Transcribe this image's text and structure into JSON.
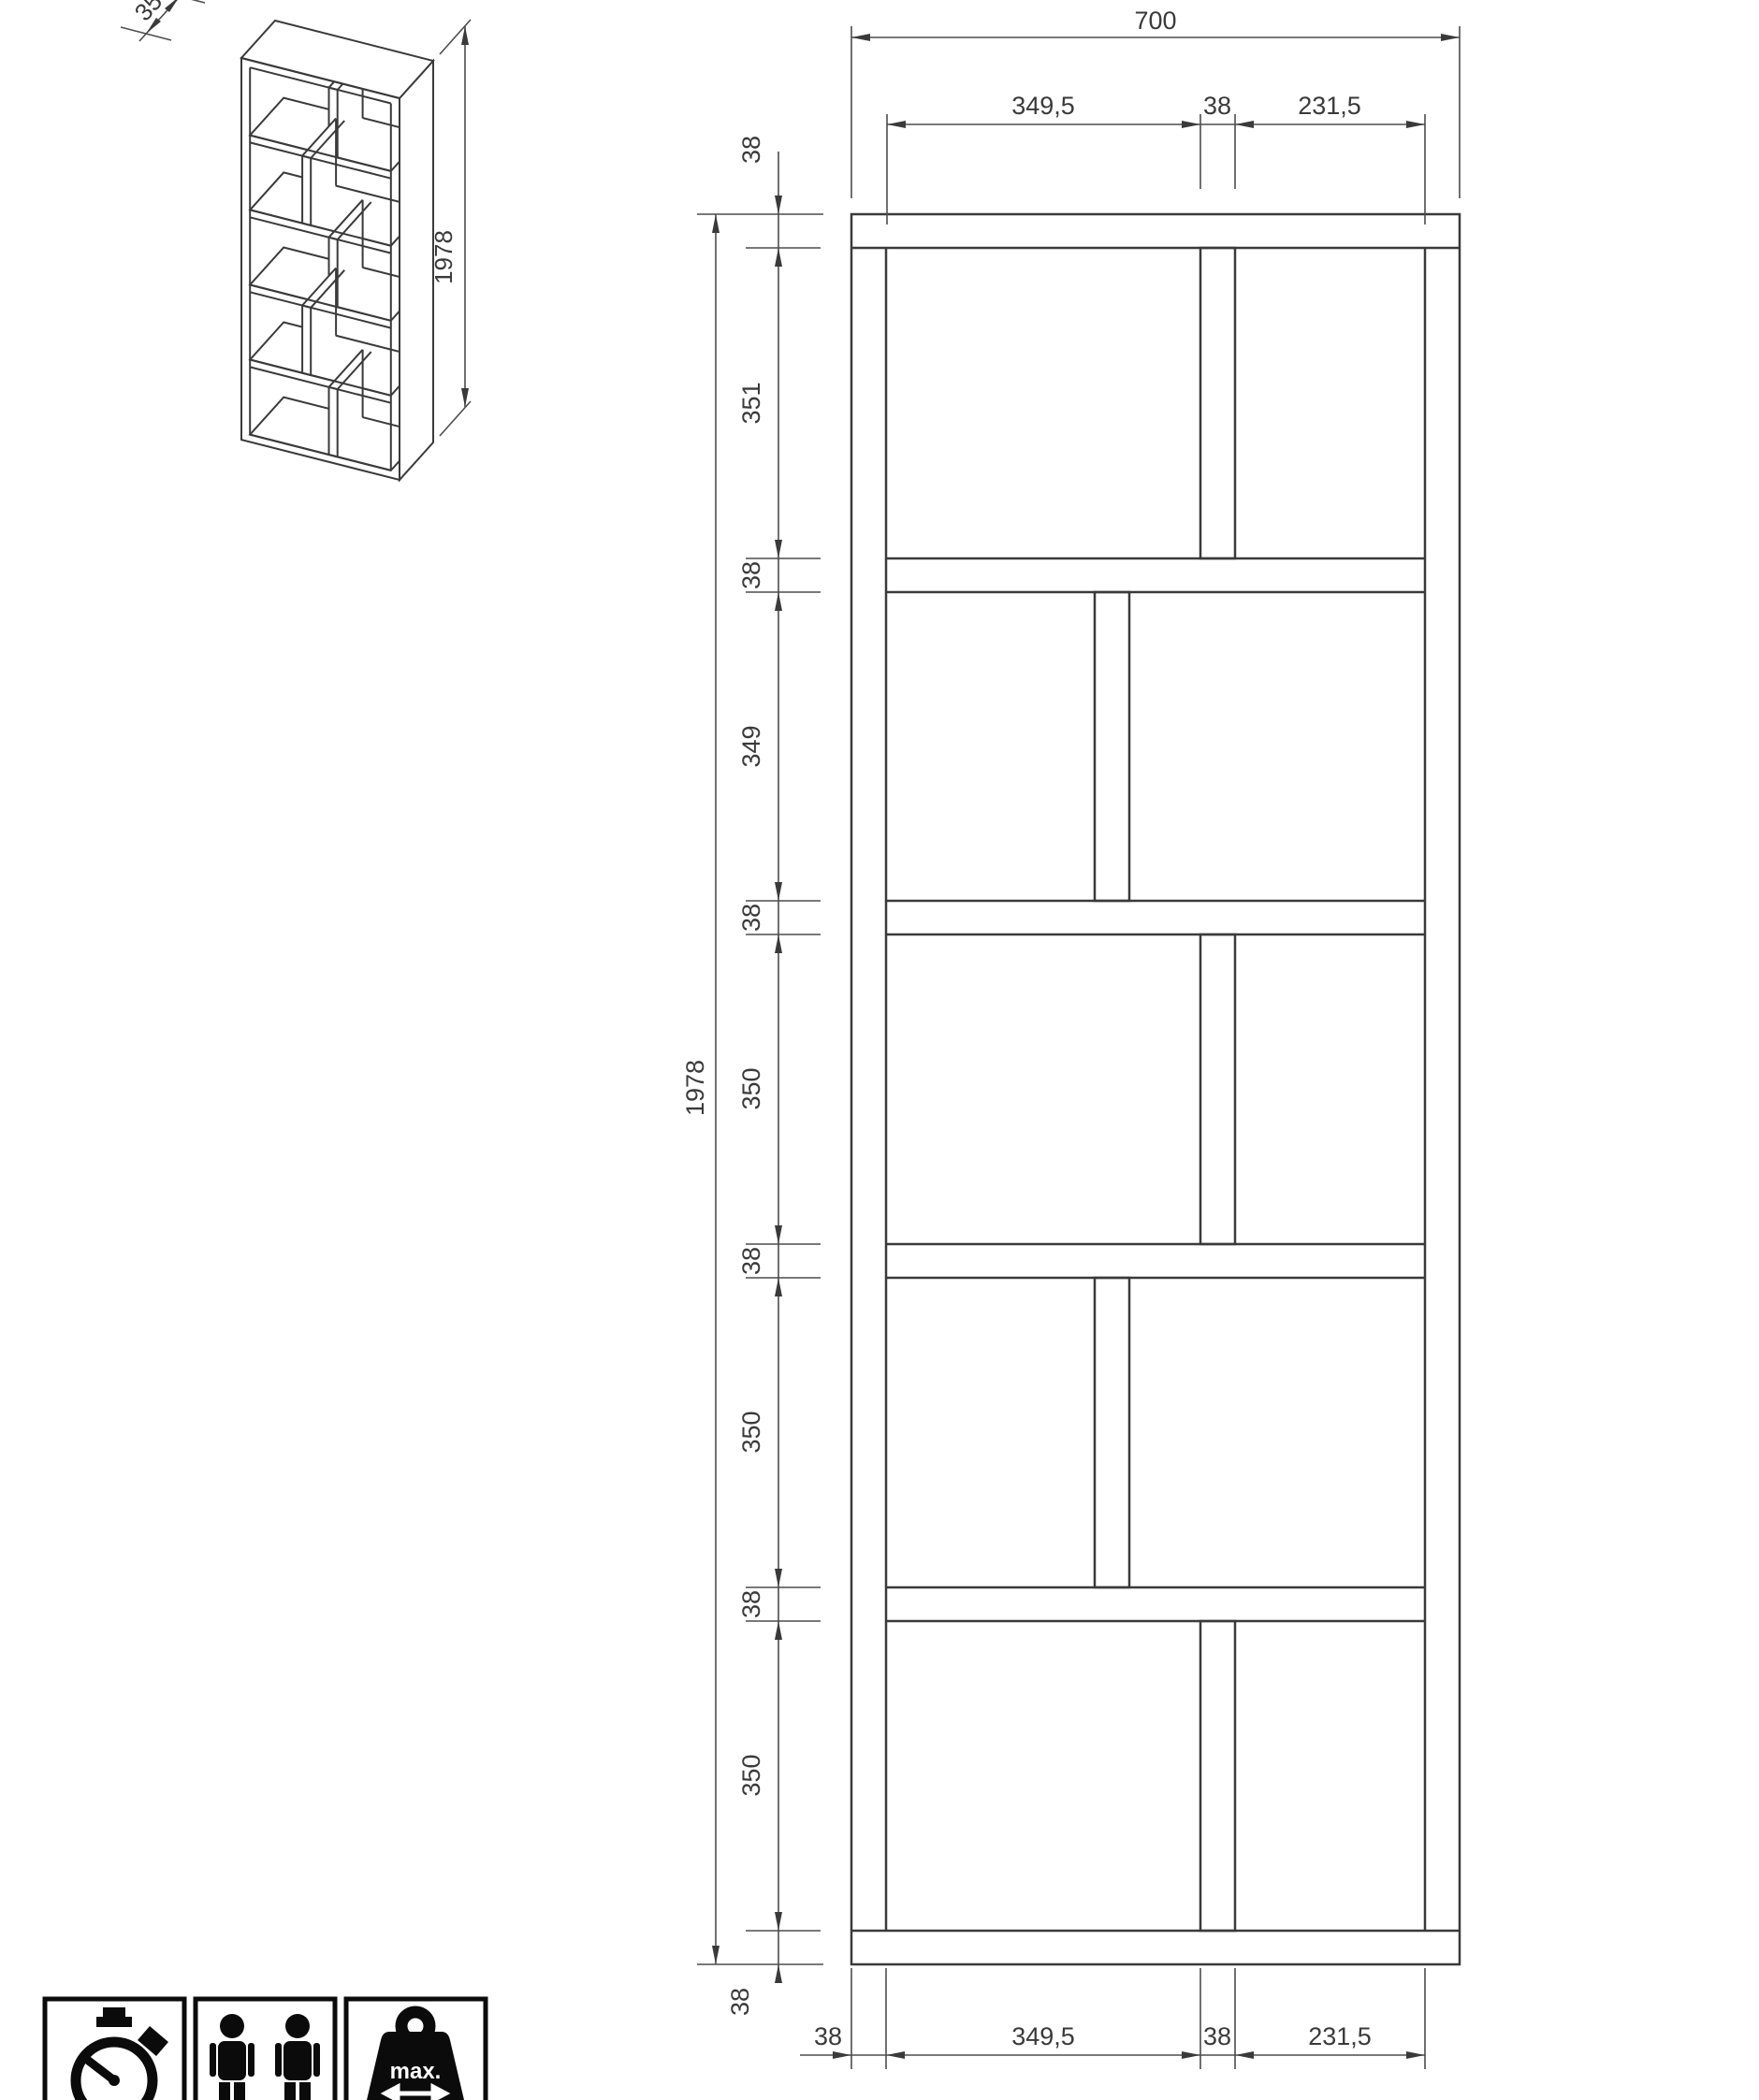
{
  "page": {
    "background": "#ffffff",
    "line_color": "#3a3a3a"
  },
  "isometric_view": {
    "depth_dim_label": "350",
    "height_dim_label": "1978"
  },
  "front_elevation": {
    "overall_width_label": "700",
    "overall_height_label": "1978",
    "top_dim_labels": {
      "left_opening": "349,5",
      "divider": "38",
      "right_opening": "231,5"
    },
    "left_dim_labels": [
      "38",
      "351",
      "38",
      "349",
      "38",
      "350",
      "38",
      "350",
      "38",
      "350",
      "38"
    ],
    "bottom_dim_labels": {
      "side_panel": "38",
      "left_opening": "349,5",
      "divider": "38",
      "right_opening": "231,5"
    }
  },
  "footer_icons": {
    "stopwatch_icon": "assembly-time",
    "two_persons_icon": "two-person-assembly",
    "weight_icon_label": "max."
  }
}
